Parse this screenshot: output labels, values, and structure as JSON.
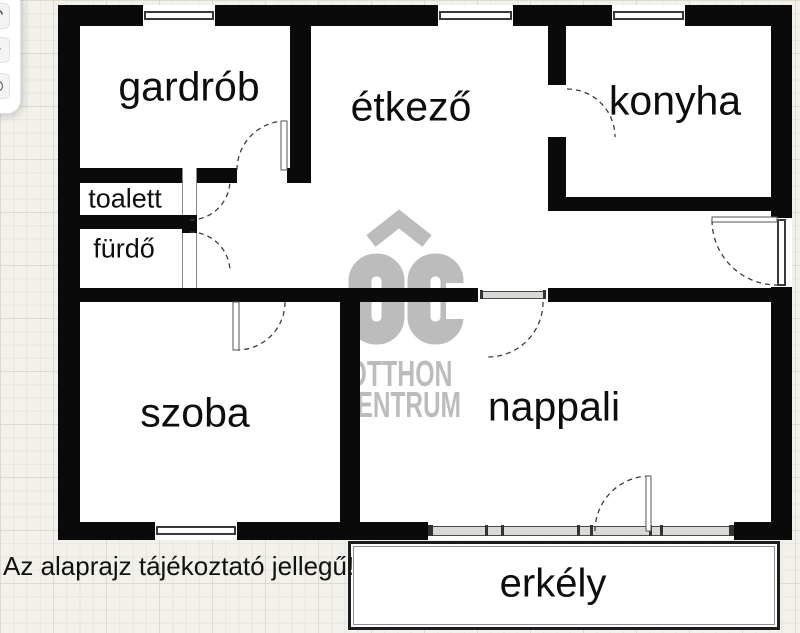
{
  "viewer": {
    "toolbar": {
      "buttons": [
        {
          "name": "undo-icon",
          "glyph": "↶"
        },
        {
          "name": "minus-icon",
          "glyph": "−"
        },
        {
          "name": "target-icon",
          "glyph": "◎"
        }
      ]
    }
  },
  "floorplan": {
    "rooms": [
      {
        "id": "gardrob",
        "label": "gardrób"
      },
      {
        "id": "etkezo",
        "label": "étkező"
      },
      {
        "id": "konyha",
        "label": "konyha"
      },
      {
        "id": "toalett",
        "label": "toalett"
      },
      {
        "id": "furdo",
        "label": "fürdő"
      },
      {
        "id": "szoba",
        "label": "szoba"
      },
      {
        "id": "nappali",
        "label": "nappali"
      },
      {
        "id": "erkely",
        "label": "erkély"
      }
    ],
    "disclaimer": "Az alaprajz tájékoztató jellegű!",
    "watermark": {
      "logo_text": "OC",
      "line1": "OTTHON",
      "line2": "CENTRUM"
    },
    "colors": {
      "wall": "#0a0a0a",
      "canvas": "#f2f1eb",
      "room_fill": "#ffffff",
      "watermark": "#bcbcbc"
    }
  }
}
